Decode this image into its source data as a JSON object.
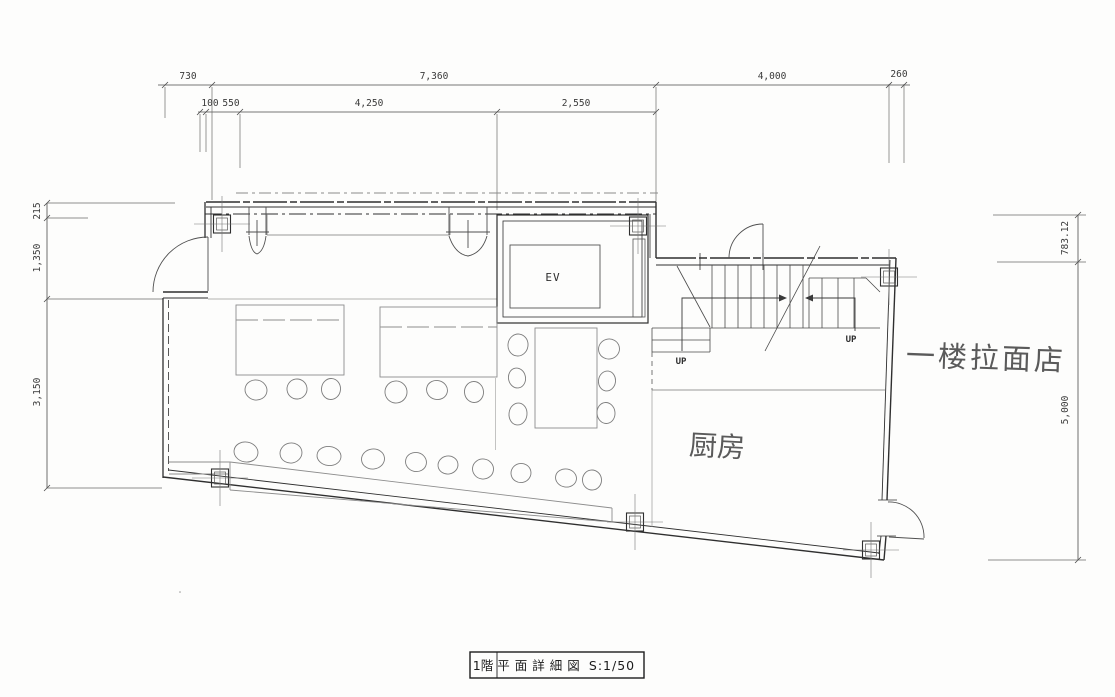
{
  "drawing": {
    "type": "architectural-floor-plan",
    "colors": {
      "ink": "#2f2f2f",
      "pencil": "#5a5a5a",
      "paper": "#fdfdfc"
    },
    "title_block": {
      "floor": "1階",
      "name": "平面詳細図",
      "scale": "S:1/50"
    },
    "labels": {
      "elevator": "EV",
      "up_left": "UP",
      "up_right": "UP",
      "kitchen": "厨房",
      "annotation_ramen_shop": "一楼拉面店"
    },
    "dimensions": {
      "top_row1": {
        "a": "730",
        "b": "7,360",
        "c": "4,000",
        "d": "260"
      },
      "top_row2": {
        "a": "100",
        "b": "550",
        "c": "4,250",
        "d": "2,550"
      },
      "left": {
        "a": "215",
        "b": "1,350",
        "c": "3,150"
      },
      "right": {
        "a": "783.12",
        "b": "5,000"
      }
    }
  }
}
